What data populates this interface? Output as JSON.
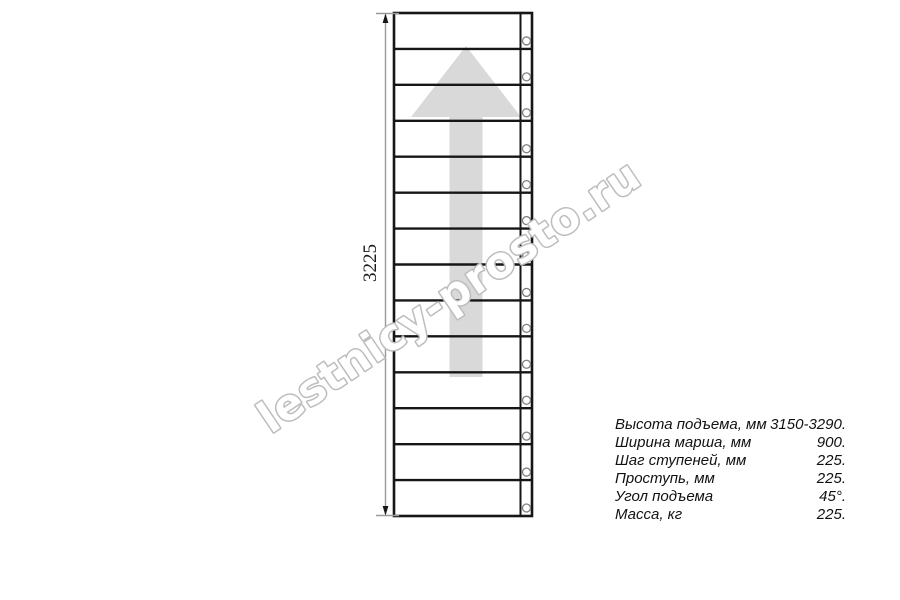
{
  "drawing": {
    "dimension_label": "3225",
    "num_steps": 14,
    "watermark_text": "lestnicy-prosto.ru",
    "colors": {
      "line": "#161616",
      "dimension_line": "#9a9a9a",
      "arrow_fill": "#d9d9d9",
      "circle_stroke": "#7f7f7f",
      "watermark_outline": "#bdbdbd"
    }
  },
  "specs": {
    "rows": [
      {
        "label": "Высота подъема, мм",
        "value": "3150-3290."
      },
      {
        "label": "Ширина марша, мм",
        "value": "900."
      },
      {
        "label": "Шаг ступеней, мм",
        "value": "225."
      },
      {
        "label": "Проступь, мм",
        "value": "225."
      },
      {
        "label": "Угол подъема",
        "value": "45°."
      },
      {
        "label": "Масса, кг",
        "value": "225."
      }
    ]
  }
}
